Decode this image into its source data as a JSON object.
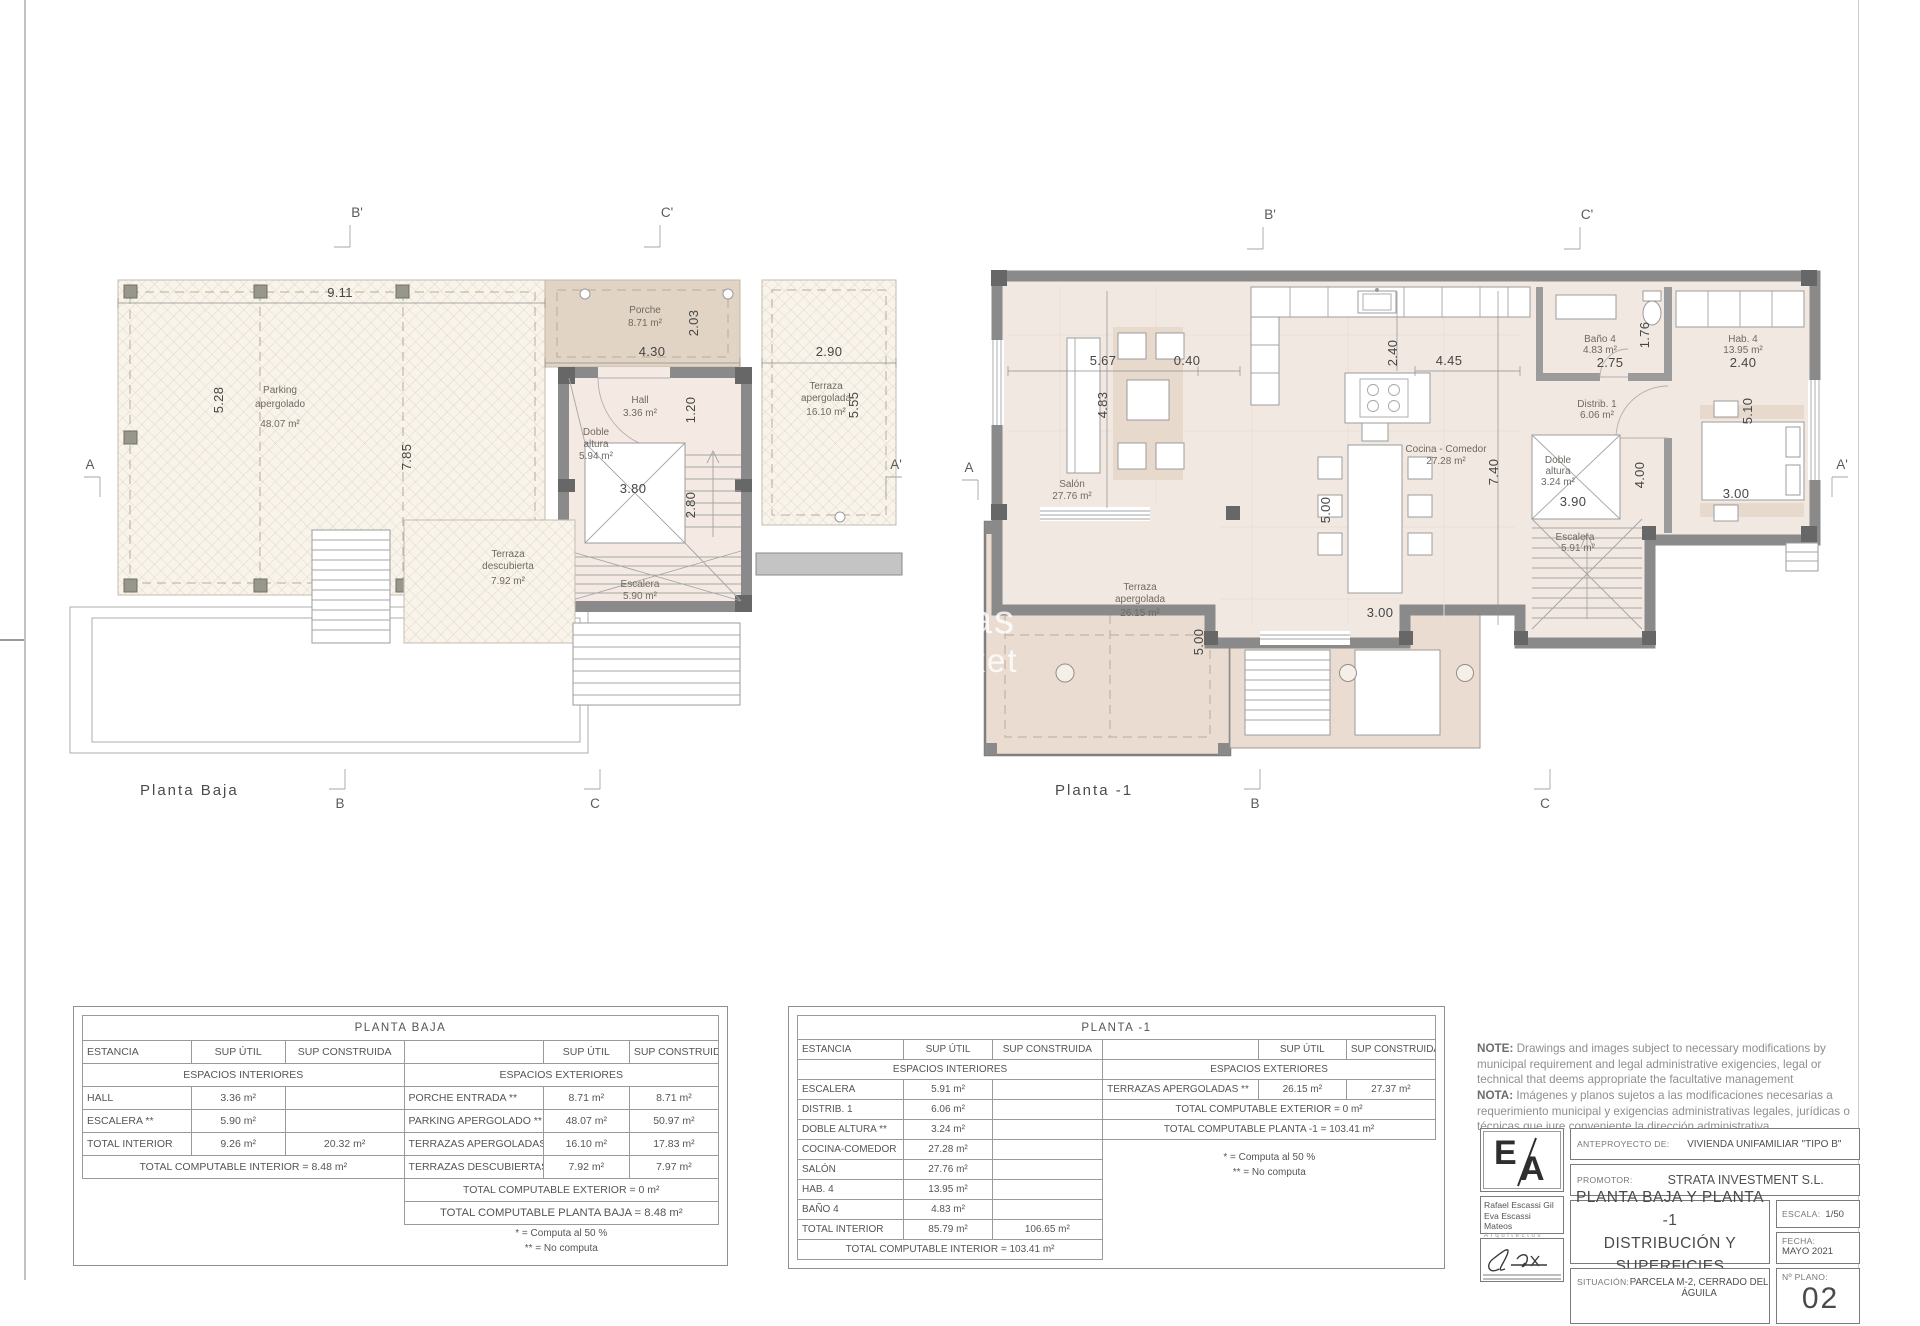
{
  "watermark": {
    "line1": "verseas",
    "line2": "y Market"
  },
  "plan_baja": {
    "title": "Planta Baja",
    "marker_a": "A",
    "marker_a2": "A'",
    "marker_b": "B",
    "marker_b2": "B'",
    "marker_c": "C",
    "marker_c2": "C'",
    "parking_1": "Parking",
    "parking_2": "apergolado",
    "parking_area": "48.07 m²",
    "porche_1": "Porche",
    "porche_area": "8.71 m²",
    "hall_1": "Hall",
    "hall_area": "3.36 m²",
    "doble_1": "Doble",
    "doble_2": "altura",
    "doble_area": "5.94 m²",
    "escalera_1": "Escalera",
    "escalera_area": "5.90 m²",
    "terr_ap_1": "Terraza",
    "terr_ap_2": "apergolada",
    "terr_ap_area": "16.10 m²",
    "terr_desc_1": "Terraza",
    "terr_desc_2": "descubierta",
    "terr_desc_area": "7.92 m²",
    "dim_911": "9.11",
    "dim_528": "5.28",
    "dim_785": "7.85",
    "dim_430": "4.30",
    "dim_203": "2.03",
    "dim_290": "2.90",
    "dim_555": "5.55",
    "dim_120": "1.20",
    "dim_380": "3.80",
    "dim_280": "2.80"
  },
  "plan_m1": {
    "title": "Planta -1",
    "marker_a": "A",
    "marker_a2": "A'",
    "marker_b": "B",
    "marker_b2": "B'",
    "marker_c": "C",
    "marker_c2": "C'",
    "salon_1": "Salón",
    "salon_area": "27.76 m²",
    "cocina_1": "Cocina - Comedor",
    "cocina_area": "27.28 m²",
    "terraza_1": "Terraza",
    "terraza_2": "apergolada",
    "terraza_area": "26.15 m²",
    "bano_1": "Baño 4",
    "bano_area": "4.83 m²",
    "hab_1": "Hab. 4",
    "hab_area": "13.95 m²",
    "distrib_1": "Distrib. 1",
    "distrib_area": "6.06 m²",
    "doble_1": "Doble",
    "doble_2": "altura",
    "doble_area": "3.24 m²",
    "escalera_1": "Escalera",
    "escalera_area": "5.91 m²",
    "dim_567": "5.67",
    "dim_040": "0.40",
    "dim_483": "4.83",
    "dim_240a": "2.40",
    "dim_445": "4.45",
    "dim_740": "7.40",
    "dim_500a": "5.00",
    "dim_300a": "3.00",
    "dim_500b": "5.00",
    "dim_275": "2.75",
    "dim_176": "1.76",
    "dim_240b": "2.40",
    "dim_510": "5.10",
    "dim_390": "3.90",
    "dim_400": "4.00",
    "dim_300b": "3.00"
  },
  "table_baja": {
    "title": "PLANTA BAJA",
    "col_estancia": "ESTANCIA",
    "col_util": "SUP ÚTIL",
    "col_cons": "SUP CONSTRUIDA",
    "sec_int": "ESPACIOS INTERIORES",
    "sec_ext": "ESPACIOS EXTERIORES",
    "int_rows": [
      {
        "name": "HALL",
        "util": "3.36 m²",
        "cons": ""
      },
      {
        "name": "ESCALERA **",
        "util": "5.90 m²",
        "cons": ""
      },
      {
        "name": "TOTAL INTERIOR",
        "util": "9.26 m²",
        "cons": "20.32 m²"
      }
    ],
    "int_total": "TOTAL COMPUTABLE INTERIOR = 8.48 m²",
    "ext_rows": [
      {
        "name": "PORCHE ENTRADA **",
        "util": "8.71 m²",
        "cons": "8.71 m²"
      },
      {
        "name": "PARKING APERGOLADO **",
        "util": "48.07 m²",
        "cons": "50.97 m²"
      },
      {
        "name": "TERRAZAS APERGOLADAS **",
        "util": "16.10 m²",
        "cons": "17.83 m²"
      },
      {
        "name": "TERRAZAS DESCUBIERTAS **",
        "util": "7.92 m²",
        "cons": "7.97 m²"
      }
    ],
    "ext_total": "TOTAL COMPUTABLE EXTERIOR = 0 m²",
    "planta_total": "TOTAL COMPUTABLE PLANTA BAJA = 8.48 m²",
    "legend1": "* = Computa al 50 %",
    "legend2": "** = No computa"
  },
  "table_m1": {
    "title": "PLANTA  -1",
    "col_estancia": "ESTANCIA",
    "col_util": "SUP ÚTIL",
    "col_cons": "SUP CONSTRUIDA",
    "sec_int": "ESPACIOS INTERIORES",
    "sec_ext": "ESPACIOS EXTERIORES",
    "int_rows": [
      {
        "name": "ESCALERA",
        "util": "5.91 m²",
        "cons": ""
      },
      {
        "name": "DISTRIB. 1",
        "util": "6.06 m²",
        "cons": ""
      },
      {
        "name": "DOBLE ALTURA **",
        "util": "3.24 m²",
        "cons": ""
      },
      {
        "name": "COCINA-COMEDOR",
        "util": "27.28 m²",
        "cons": ""
      },
      {
        "name": "SALÓN",
        "util": "27.76 m²",
        "cons": ""
      },
      {
        "name": "HAB. 4",
        "util": "13.95 m²",
        "cons": ""
      },
      {
        "name": "BAÑO 4",
        "util": "4.83 m²",
        "cons": ""
      },
      {
        "name": "TOTAL INTERIOR",
        "util": "85.79 m²",
        "cons": "106.65 m²"
      }
    ],
    "int_total": "TOTAL COMPUTABLE INTERIOR = 103.41 m²",
    "ext_row": {
      "name": "TERRAZAS APERGOLADAS **",
      "util": "26.15 m²",
      "cons": "27.37 m²"
    },
    "ext_total": "TOTAL COMPUTABLE EXTERIOR = 0 m²",
    "planta_total": "TOTAL COMPUTABLE PLANTA -1 = 103.41 m²",
    "legend1": "* = Computa al 50 %",
    "legend2": "** = No computa"
  },
  "notes": {
    "en_label": "NOTE:",
    "en_text": "Drawings and images subject to necessary modifications by municipal requirement and legal administrative exigencies, legal or technical that deems appropriate the facultative management",
    "es_label": "NOTA:",
    "es_text": "Imágenes y planos sujetos a las modificaciones necesarias a requerimiento municipal y exigencias administrativas legales, jurídicas o técnicas que jure conveniente la dirección administrativa"
  },
  "titleblock": {
    "logo_e": "E",
    "logo_a": "A",
    "architect1": "Rafael Escassi Gil",
    "architect2": "Eva Escassi Mateos",
    "architect3": "Arquitectos",
    "anteproyecto_label": "ANTEPROYECTO DE:",
    "anteproyecto_value": "VIVIENDA UNIFAMILIAR \"TIPO B\"",
    "promotor_label": "PROMOTOR:",
    "promotor_value": "STRATA INVESTMENT S.L.",
    "plano_title1": "PLANTA BAJA Y PLANTA -1",
    "plano_title2": "DISTRIBUCIÓN Y SUPERFICIES",
    "escala_label": "ESCALA:",
    "escala_value": "1/50",
    "fecha_label": "FECHA:",
    "fecha_value": "MAYO 2021",
    "situacion_label": "SITUACIÓN:",
    "situacion_value": "PARCELA M-2, CERRADO DEL ÁGUILA",
    "nplano_label": "Nº PLANO:",
    "nplano_value": "02"
  }
}
